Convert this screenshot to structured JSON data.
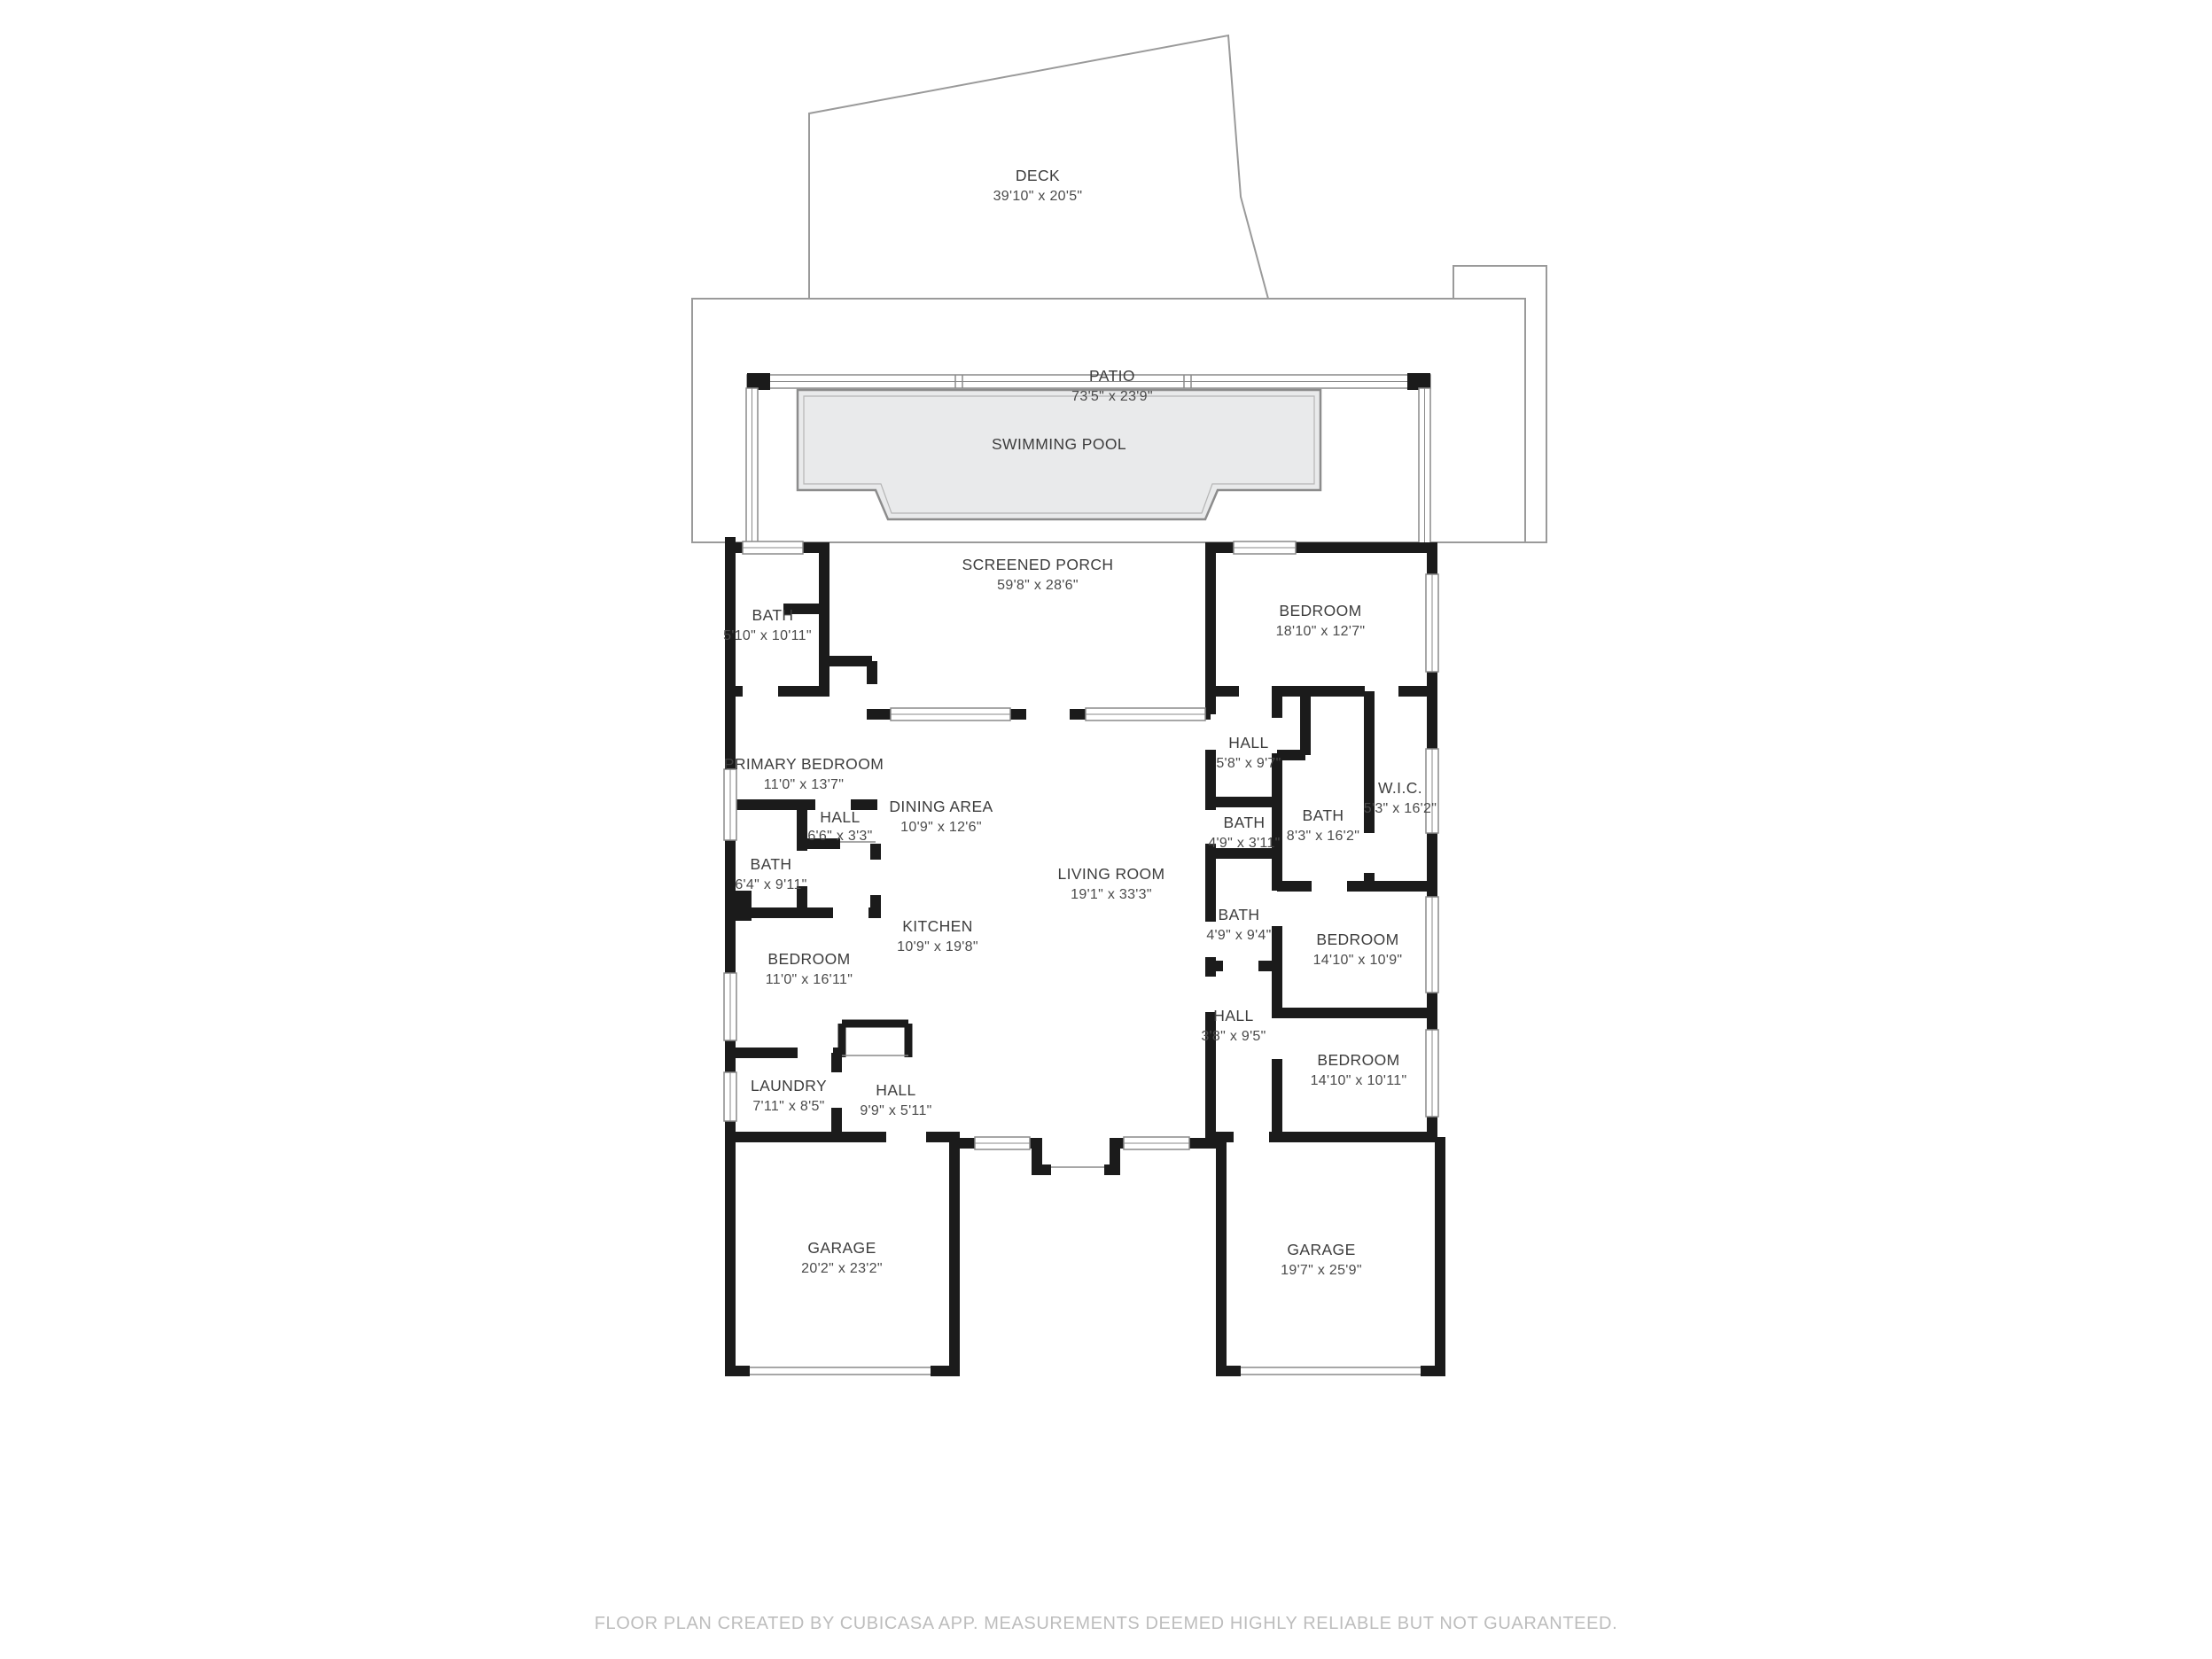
{
  "palette": {
    "wall": "#1b1b1b",
    "thin_outline": "#9a9a9a",
    "pool_fill": "#e9eaeb",
    "pool_stroke": "#8c8c8c",
    "label_text": "#3d3d3d",
    "footer_text": "#bdbdbd",
    "background": "#ffffff"
  },
  "rooms": {
    "deck": {
      "name": "DECK",
      "dims": "39'10\" x 20'5\""
    },
    "patio": {
      "name": "PATIO",
      "dims": "73'5\" x 23'9\""
    },
    "swimming_pool": {
      "name": "SWIMMING POOL"
    },
    "screened_porch": {
      "name": "SCREENED PORCH",
      "dims": "59'8\" x 28'6\""
    },
    "bath_upper_left": {
      "name": "BATH",
      "dims": "5'10\" x 10'11\""
    },
    "bedroom_upper_right": {
      "name": "BEDROOM",
      "dims": "18'10\" x 12'7\""
    },
    "primary_bedroom": {
      "name": "PRIMARY BEDROOM",
      "dims": "11'0\" x 13'7\""
    },
    "dining_area": {
      "name": "DINING AREA",
      "dims": "10'9\" x 12'6\""
    },
    "hall_upper_right": {
      "name": "HALL",
      "dims": "5'8\" x 9'7\""
    },
    "wic": {
      "name": "W.I.C.",
      "dims": "5'3\" x 16'2\""
    },
    "bath_ensuite_right": {
      "name": "BATH",
      "dims": "8'3\" x 16'2\""
    },
    "bath_powder_right": {
      "name": "BATH",
      "dims": "4'9\" x 3'11\""
    },
    "hall_left": {
      "name": "HALL",
      "dims": "6'6\" x 3'3\""
    },
    "bath_left": {
      "name": "BATH",
      "dims": "6'4\" x 9'11\""
    },
    "living_room": {
      "name": "LIVING ROOM",
      "dims": "19'1\" x 33'3\""
    },
    "kitchen": {
      "name": "KITCHEN",
      "dims": "10'9\" x 19'8\""
    },
    "bath_mid_right": {
      "name": "BATH",
      "dims": "4'9\" x 9'4\""
    },
    "bedroom_mid_right": {
      "name": "BEDROOM",
      "dims": "14'10\" x 10'9\""
    },
    "bedroom_left": {
      "name": "BEDROOM",
      "dims": "11'0\" x 16'11\""
    },
    "hall_lower_right": {
      "name": "HALL",
      "dims": "3'8\" x 9'5\""
    },
    "bedroom_lower_right": {
      "name": "BEDROOM",
      "dims": "14'10\" x 10'11\""
    },
    "laundry": {
      "name": "LAUNDRY",
      "dims": "7'11\" x 8'5\""
    },
    "hall_lower_left": {
      "name": "HALL",
      "dims": "9'9\" x 5'11\""
    },
    "garage_left": {
      "name": "GARAGE",
      "dims": "20'2\" x 23'2\""
    },
    "garage_right": {
      "name": "GARAGE",
      "dims": "19'7\" x 25'9\""
    }
  },
  "footer": {
    "disclaimer": "FLOOR PLAN CREATED BY CUBICASA APP. MEASUREMENTS DEEMED HIGHLY RELIABLE BUT NOT GUARANTEED."
  }
}
